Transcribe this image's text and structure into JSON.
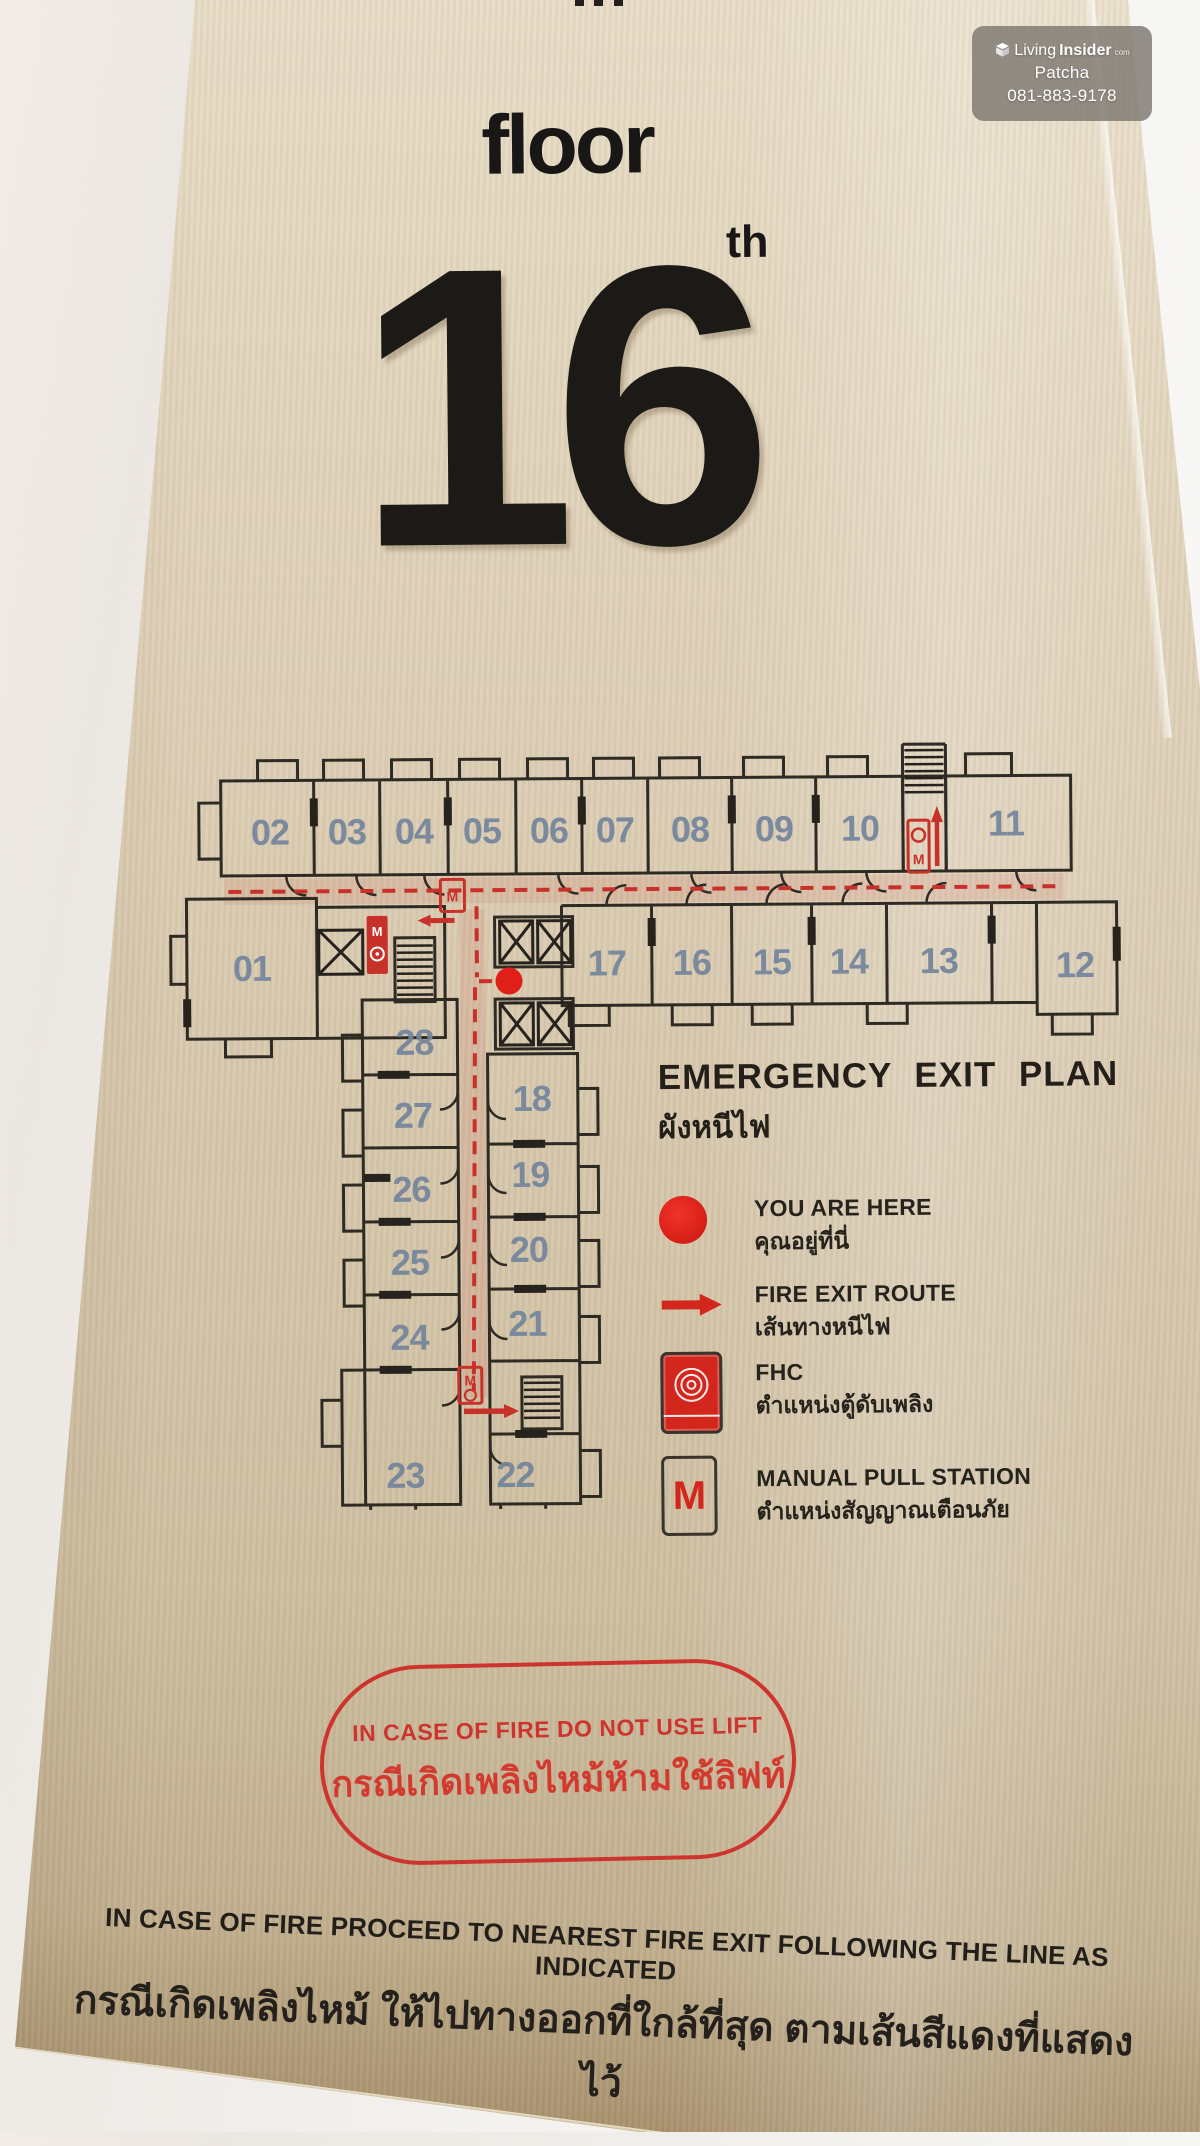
{
  "watermark": {
    "icon": "box-logo-icon",
    "brand_light": "Living",
    "brand_bold": "Insider",
    "brand_suffix": "com",
    "line2": "Patcha",
    "line3": "081-883-9178"
  },
  "header": {
    "floor_label": "floor",
    "floor_suffix": "th",
    "floor_number": "16"
  },
  "plan": {
    "tag_m": "M",
    "rooms": {
      "r01": "01",
      "r02": "02",
      "r03": "03",
      "r04": "04",
      "r05": "05",
      "r06": "06",
      "r07": "07",
      "r08": "08",
      "r09": "09",
      "r10": "10",
      "r11": "11",
      "r12": "12",
      "r13": "13",
      "r14": "14",
      "r15": "15",
      "r16": "16",
      "r17": "17",
      "r18": "18",
      "r19": "19",
      "r20": "20",
      "r21": "21",
      "r22": "22",
      "r23": "23",
      "r24": "24",
      "r25": "25",
      "r26": "26",
      "r27": "27",
      "r28": "28"
    }
  },
  "legend": {
    "title_en": "EMERGENCY EXIT PLAN",
    "title_th": "ผังหนีไฟ",
    "items": [
      {
        "icon": "you-are-here-dot-icon",
        "en": "YOU ARE HERE",
        "th": "คุณอยู่ที่นี่"
      },
      {
        "icon": "fire-exit-route-arrow-icon",
        "en": "FIRE EXIT ROUTE",
        "th": "เส้นทางหนีไฟ"
      },
      {
        "icon": "fhc-cabinet-icon",
        "en": "FHC",
        "th": "ตำแหน่งตู้ดับเพลิง"
      },
      {
        "icon": "manual-pull-station-icon",
        "en": "MANUAL PULL STATION",
        "th": "ตำแหน่งสัญญาณเตือนภัย"
      }
    ]
  },
  "warning_box": {
    "en": "IN CASE OF FIRE DO NOT USE LIFT",
    "th": "กรณีเกิดเพลิงไหม้ห้ามใช้ลิฟท์"
  },
  "footer": {
    "en": "IN CASE OF FIRE PROCEED TO NEAREST FIRE EXIT FOLLOWING THE LINE AS INDICATED",
    "th": "กรณีเกิดเพลิงไหม้ ให้ไปทางออกที่ใกล้ที่สุด ตามเส้นสีแดงที่แสดงไว้"
  },
  "colors": {
    "accent_red": "#cd342d",
    "route_red": "#c8302a",
    "you_are_here_red": "#e02018",
    "room_number_blue": "#74859c",
    "plate_beige": "#d7c8ad",
    "wall_white": "#f2efec",
    "wall_ink": "#2e2a24",
    "watermark_grey": "rgba(126,120,112,0.82)"
  }
}
